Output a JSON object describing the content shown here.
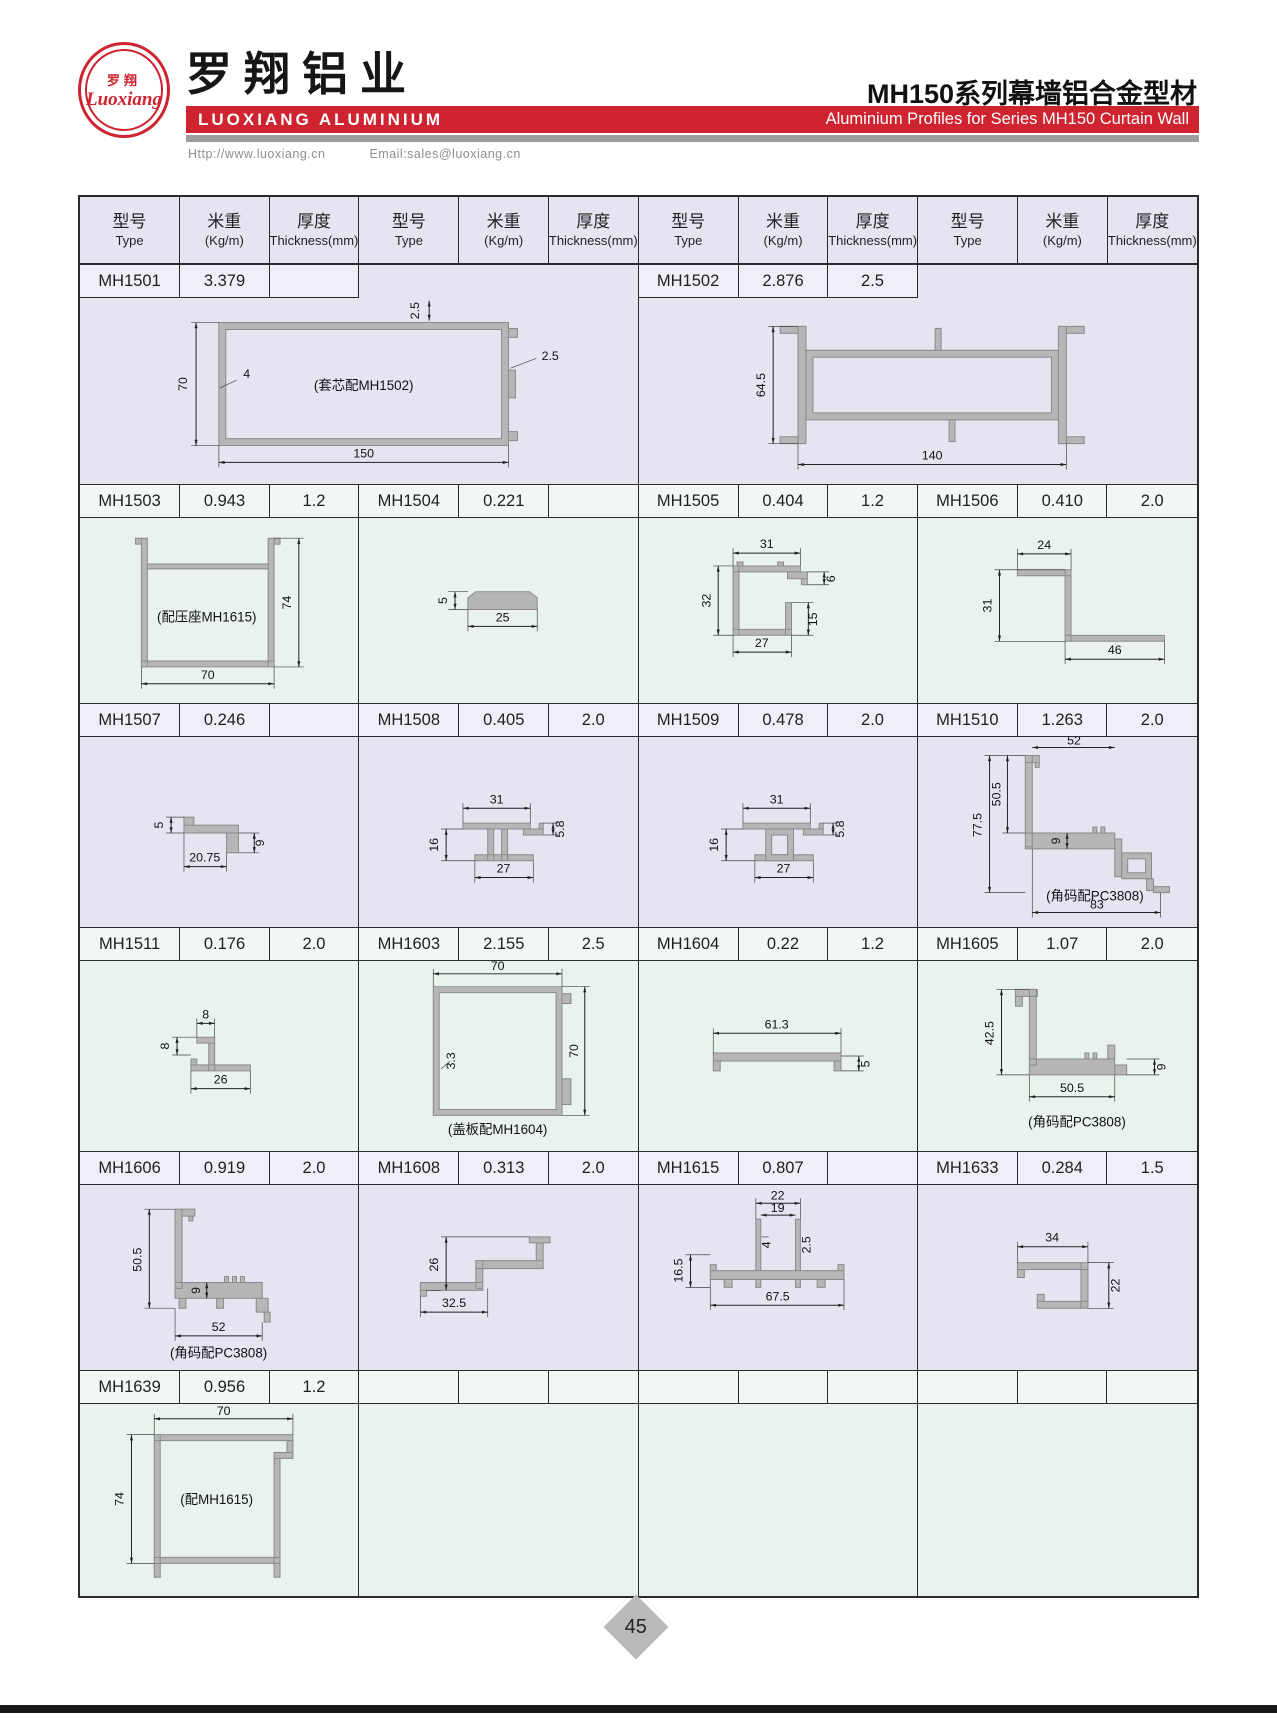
{
  "header": {
    "logo_cn": "罗翔",
    "logo_script": "Luoxiang",
    "company_cn": "罗翔铝业",
    "company_en": "LUOXIANG ALUMINIUM",
    "website": "Http://www.luoxiang.cn",
    "email": "Email:sales@luoxiang.cn",
    "series_cn": "MH150系列幕墙铝合金型材",
    "series_en": "Aluminium Profiles for Series MH150 Curtain Wall",
    "accent_color": "#cf2330"
  },
  "columns": {
    "type_cn": "型号",
    "type_en": "Type",
    "weight_cn": "米重",
    "weight_en": "(Kg/m)",
    "thickness_cn": "厚度",
    "thickness_en": "Thickness(mm)"
  },
  "products": {
    "mh1501": {
      "model": "MH1501",
      "weight": "3.379",
      "thickness": "",
      "note": "(套芯配MH1502)",
      "dims": {
        "h": "70",
        "wall": "4",
        "t_top": "2.5",
        "t_right": "2.5",
        "w": "150"
      }
    },
    "mh1502": {
      "model": "MH1502",
      "weight": "2.876",
      "thickness": "2.5",
      "dims": {
        "h": "64.5",
        "w": "140"
      }
    },
    "mh1503": {
      "model": "MH1503",
      "weight": "0.943",
      "thickness": "1.2",
      "note": "(配压座MH1615)",
      "dims": {
        "h": "74",
        "w": "70"
      }
    },
    "mh1504": {
      "model": "MH1504",
      "weight": "0.221",
      "thickness": "",
      "dims": {
        "h": "5",
        "w": "25"
      }
    },
    "mh1505": {
      "model": "MH1505",
      "weight": "0.404",
      "thickness": "1.2",
      "dims": {
        "top": "31",
        "left": "32",
        "r1": "6",
        "r2": "15",
        "bottom": "27"
      }
    },
    "mh1506": {
      "model": "MH1506",
      "weight": "0.410",
      "thickness": "2.0",
      "dims": {
        "top": "24",
        "left": "31",
        "bottom": "46"
      }
    },
    "mh1507": {
      "model": "MH1507",
      "weight": "0.246",
      "thickness": "",
      "dims": {
        "left": "5",
        "right": "9",
        "bottom": "20.75"
      }
    },
    "mh1508": {
      "model": "MH1508",
      "weight": "0.405",
      "thickness": "2.0",
      "dims": {
        "top": "31",
        "tr": "5.8",
        "left": "16",
        "bottom": "27"
      }
    },
    "mh1509": {
      "model": "MH1509",
      "weight": "0.478",
      "thickness": "2.0",
      "dims": {
        "top": "31",
        "tr": "5.8",
        "left": "16",
        "bottom": "27"
      }
    },
    "mh1510": {
      "model": "MH1510",
      "weight": "1.263",
      "thickness": "2.0",
      "note": "(角码配PC3808)",
      "dims": {
        "top": "52",
        "left": "77.5",
        "inner": "50.5",
        "mid": "9",
        "bottom": "83"
      }
    },
    "mh1511": {
      "model": "MH1511",
      "weight": "0.176",
      "thickness": "2.0",
      "dims": {
        "top": "8",
        "left": "8",
        "bottom": "26"
      }
    },
    "mh1603": {
      "model": "MH1603",
      "weight": "2.155",
      "thickness": "2.5",
      "note": "(盖板配MH1604)",
      "dims": {
        "top": "70",
        "wall": "3.3",
        "right": "70"
      }
    },
    "mh1604": {
      "model": "MH1604",
      "weight": "0.22",
      "thickness": "1.2",
      "dims": {
        "top": "61.3",
        "right": "5"
      }
    },
    "mh1605": {
      "model": "MH1605",
      "weight": "1.07",
      "thickness": "2.0",
      "note": "(角码配PC3808)",
      "dims": {
        "left": "42.5",
        "right": "9",
        "bottom": "50.5"
      }
    },
    "mh1606": {
      "model": "MH1606",
      "weight": "0.919",
      "thickness": "2.0",
      "note": "(角码配PC3808)",
      "dims": {
        "left": "50.5",
        "mid": "9",
        "bottom": "52"
      }
    },
    "mh1608": {
      "model": "MH1608",
      "weight": "0.313",
      "thickness": "2.0",
      "dims": {
        "left": "26",
        "bottom": "32.5"
      }
    },
    "mh1615": {
      "model": "MH1615",
      "weight": "0.807",
      "thickness": "",
      "dims": {
        "t1": "22",
        "t2": "19",
        "w4": "4",
        "t25": "2.5",
        "left": "16.5",
        "bottom": "67.5"
      }
    },
    "mh1633": {
      "model": "MH1633",
      "weight": "0.284",
      "thickness": "1.5",
      "dims": {
        "top": "34",
        "right": "22"
      }
    },
    "mh1639": {
      "model": "MH1639",
      "weight": "0.956",
      "thickness": "1.2",
      "note": "(配MH1615)",
      "dims": {
        "top": "70",
        "left": "74"
      }
    }
  },
  "page_number": "45"
}
